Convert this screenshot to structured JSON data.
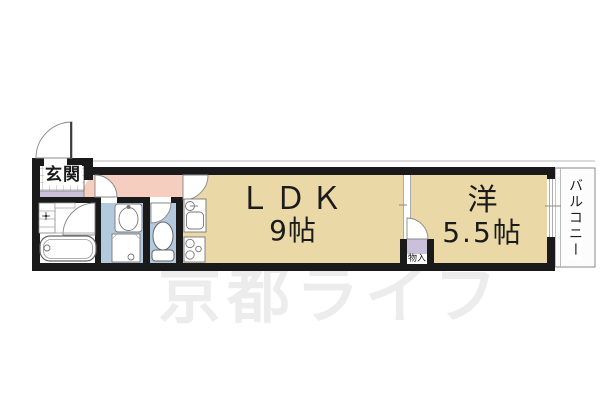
{
  "watermark": {
    "text": "京都ライフ"
  },
  "floorplan": {
    "genkan": {
      "label": "玄関"
    },
    "ldk": {
      "label": "ＬＤＫ",
      "size": "9帖"
    },
    "western_room": {
      "label": "洋",
      "size": "5.5帖"
    },
    "balcony": {
      "label": "バルコニー"
    },
    "closet": {
      "label": "物入"
    },
    "icon_names": [
      "entrance-door-swing-icon",
      "door-swing-icon",
      "sliding-door-icon",
      "window-icon",
      "tile-floor-icon",
      "vanity-icon",
      "faucet-icon",
      "bathtub-icon",
      "washbasin-icon",
      "washing-machine-icon",
      "toilet-icon",
      "kitchen-sink-icon",
      "stove-icon"
    ],
    "colors": {
      "wall": "#1a1a1a",
      "tatami_room": "#ead9a7",
      "hallway": "#f5cebf",
      "wet_room": "#b3c9dd",
      "step_and_closet": "#cbc0da",
      "fixture_line": "#777777",
      "watermark": "#ececec"
    }
  }
}
